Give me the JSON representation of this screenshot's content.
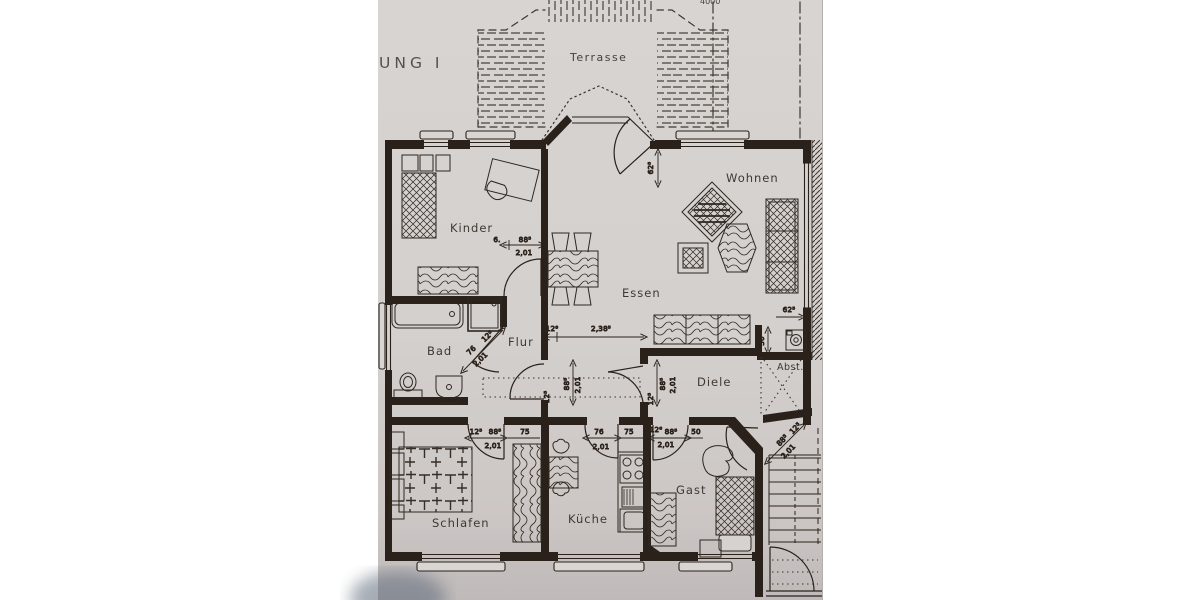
{
  "title_fragment": "UNG I",
  "top_dim_fragment": "4000",
  "terrace": {
    "label": "Terrasse"
  },
  "rooms": {
    "kinder": "Kinder",
    "wohnen": "Wohnen",
    "essen": "Essen",
    "bad": "Bad",
    "flur": "Flur",
    "diele": "Diele",
    "abst": "Abst.",
    "schlafen": "Schlafen",
    "kueche": "Küche",
    "gast": "Gast"
  },
  "dims": {
    "kinder_door": [
      "6.",
      "88⁵",
      "2,01"
    ],
    "terrace_door": [
      "62⁵"
    ],
    "wohnen_niche": [
      "62⁵"
    ],
    "flur_width": [
      "12⁸",
      "2,38⁵"
    ],
    "bad_door": [
      "76",
      "12⁵",
      "2,01"
    ],
    "flur_west_door": [
      "12⁵",
      "88⁵",
      "2,01"
    ],
    "diele_door": [
      "12⁵",
      "88⁵",
      "2,01"
    ],
    "schlafen_door": [
      "12⁵",
      "88⁵",
      "2,01",
      "75"
    ],
    "kueche_door": [
      "76",
      "2,01",
      "75"
    ],
    "gast_door": [
      "12⁸",
      "88⁵",
      "50",
      "2,01"
    ],
    "niche_width": [
      "50"
    ],
    "entry_door": [
      "88⁵",
      "12⁵",
      "2,01"
    ]
  },
  "colors": {
    "page_bg": "#ffffff",
    "paper": "#d4d0ce",
    "ink": "#2a211a"
  }
}
